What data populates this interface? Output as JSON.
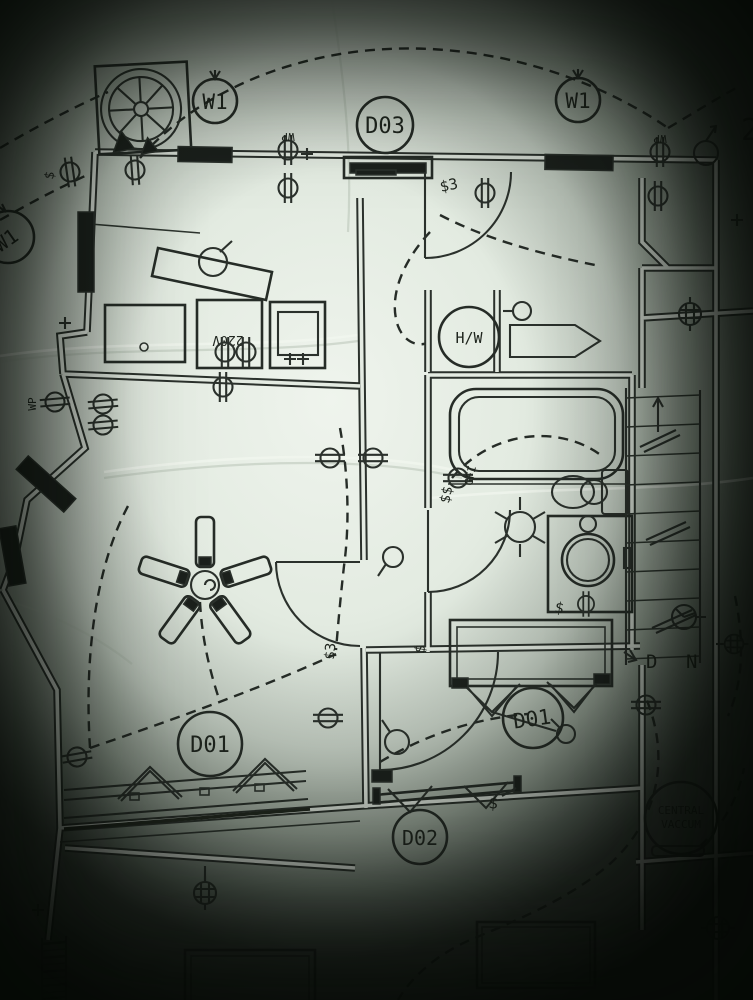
{
  "photo": {
    "kind": "scanned electrical floor plan"
  },
  "colors": {
    "paper_light": "#eff4ed",
    "paper_mid": "#e3ebe1",
    "ink": "#2b312c",
    "vignette": "#040704"
  },
  "tags": {
    "window_tag": "W1",
    "door_tag_d03": "D03",
    "door_tag_d01": "D01",
    "door_tag_d02": "D02",
    "hot_water_tank": "H/W",
    "central_vacuum_line1": "CENTRAL",
    "central_vacuum_line2": "VACCUM",
    "stair_down_d": "D",
    "stair_down_n": "N",
    "voltage_220": "220V",
    "weatherproof_outlet": "WP",
    "gfi_outlet": "GFI",
    "switch": "$",
    "switch_three_way": "$3",
    "switch_pair": "$$",
    "edge_partial_text": "2"
  },
  "symbols": [
    "duplex-outlet",
    "weatherproof-outlet",
    "special-outlet",
    "switch",
    "three-way-switch",
    "ceiling-fan",
    "ceiling-light",
    "hot-water-tank",
    "central-vacuum",
    "stairs-down",
    "bathtub",
    "toilet",
    "vanity-sink",
    "window",
    "door-swing",
    "junction-box"
  ]
}
